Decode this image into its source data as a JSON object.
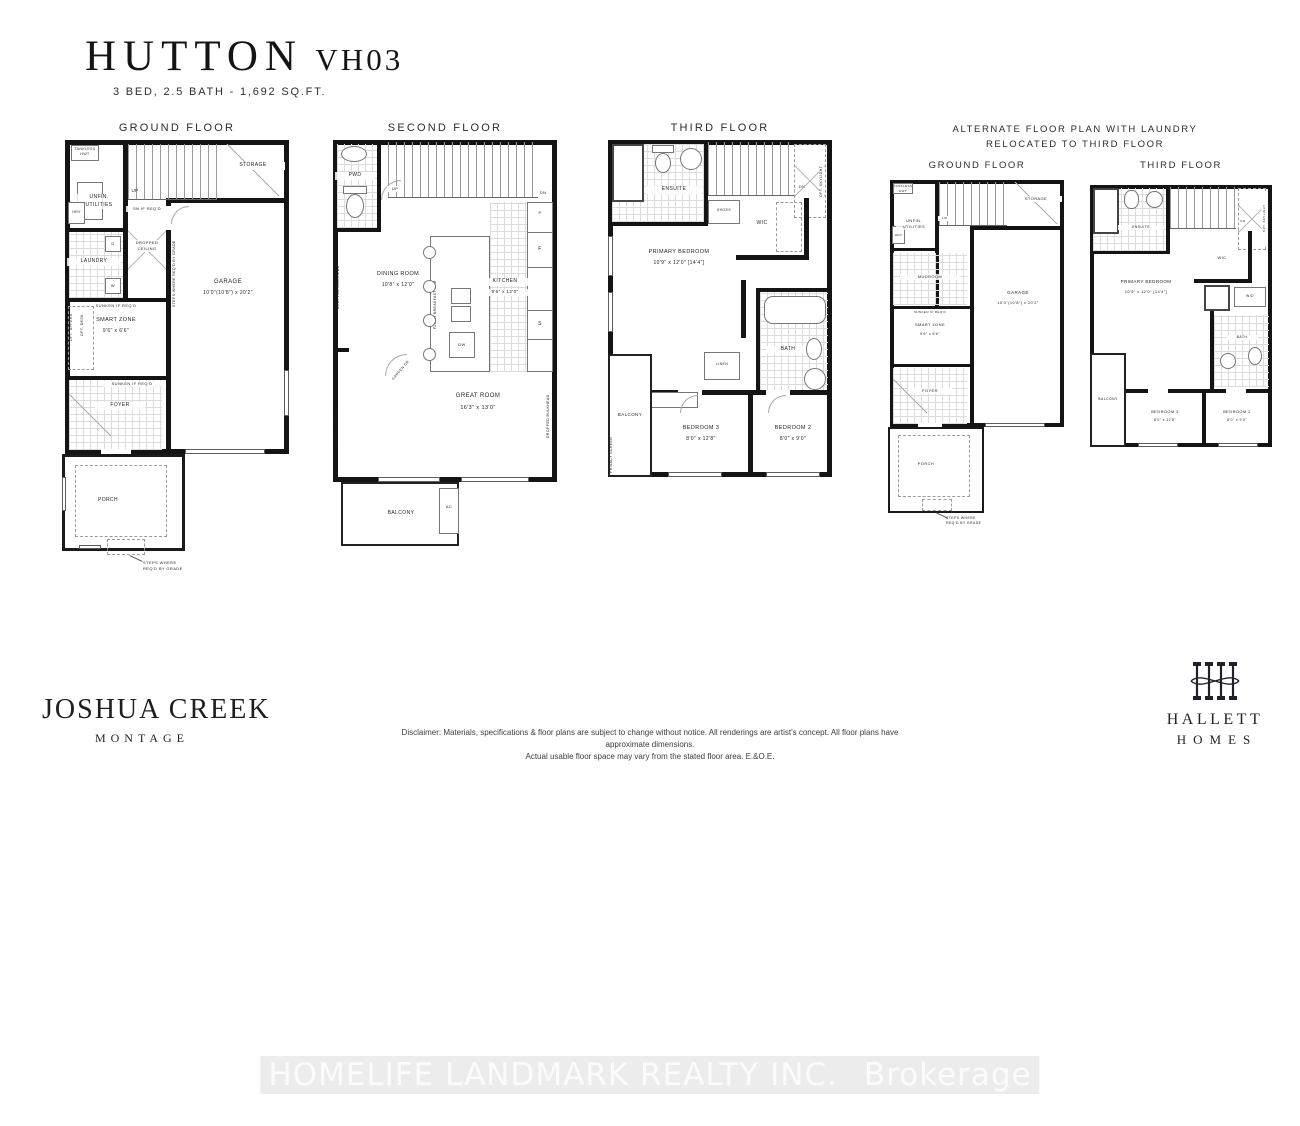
{
  "header": {
    "title": "HUTTON",
    "model": "VH03",
    "subtitle": "3 BED, 2.5 BATH - 1,692 SQ.FT."
  },
  "g": {
    "title": "GROUND FLOOR",
    "storage": "STORAGE",
    "up": "UP",
    "utilities": "UNFIN.\nUTILITIES",
    "tankless": "TANKLESS\nHWT",
    "hrv": "HRV",
    "laundry": "LAUNDRY",
    "d": "D",
    "wl": "W",
    "sn": "SN IF REQ'D",
    "dropped": "DROPPED\nCEILING",
    "garage": "GARAGE",
    "garage_dims": "10'0\"(10'8\") x 20'2\"",
    "steps_vert": "STEPS WHERE REQ'D BY GRADE",
    "sunken": "SUNKEN IF REQ'D",
    "smart": "SMART ZONE",
    "smart_dims": "9'6\" x 6'6\"",
    "opt_uppers": "OPT. UPPERS",
    "opt_desk": "OPT. DESK",
    "foyer": "FOYER",
    "sunken2": "SUNKEN IF REQ'D",
    "porch": "PORCH",
    "steps": "STEPS WHERE\nREQ'D BY GRADE"
  },
  "s": {
    "title": "SECOND FLOOR",
    "pwd": "PWD",
    "up": "UP",
    "dn": "DN",
    "dining": "DINING ROOM",
    "dining_dims": "10'8\" x 12'0\"",
    "bulkhead": "DROPPED BULKHEAD",
    "flush": "FLUSH BREAKFAST BAR",
    "dw": "DW",
    "f": "F",
    "st": "S",
    "p": "P",
    "kitchen": "KITCHEN",
    "kitchen_dims": "9'6\" x 12'0\"",
    "garden": "GARDEN DR",
    "great": "GREAT ROOM",
    "great_dims": "16'3\" x 13'0\"",
    "privacy": "PRIVACY SCREEN",
    "balcony": "BALCONY",
    "ac": "AC"
  },
  "t": {
    "title": "THIRD FLOOR",
    "ensuite": "ENSUITE",
    "dn": "DN",
    "skylight": "OPT. SKYLIGHT",
    "shoes": "SHOES",
    "wic": "WIC",
    "primary": "PRIMARY BEDROOM",
    "primary_dims": "10'9\" x 12'0\" [14'4\"]",
    "bath": "BATH",
    "linen": "LINEN",
    "balcony": "BALCONY",
    "privacy": "PRIVACY SCREEN",
    "bed3": "BEDROOM 3",
    "bed3_dims": "8'0\" x 12'8\"",
    "bed2": "BEDROOM 2",
    "bed2_dims": "8'0\" x 9'0\""
  },
  "alt": {
    "header": "ALTERNATE FLOOR PLAN WITH LAUNDRY\nRELOCATED TO THIRD FLOOR",
    "ground_title": "GROUND FLOOR",
    "third_title": "THIRD FLOOR",
    "g": {
      "storage": "STORAGE",
      "up": "UP",
      "utilities": "UNFIN.\nUTILITIES",
      "tankless": "TANKLESS\nHWT",
      "hrv": "HRV",
      "mudroom": "MUDROOM",
      "garage": "GARAGE",
      "garage_dims": "10'0\"(10'8\") x 20'2\"",
      "smart": "SMART ZONE",
      "smart_dims": "9'6\" x 6'6\"",
      "sunken": "SUNKEN IF REQ'D",
      "foyer": "FOYER",
      "porch": "PORCH",
      "steps": "STEPS WHERE\nREQ'D BY GRADE"
    },
    "t": {
      "ensuite": "ENSUITE",
      "dn": "DN",
      "wic": "WIC",
      "skylight": "OPT. SKYLIGHT",
      "primary": "PRIMARY BEDROOM",
      "primary_dims": "10'9\" x 12'0\" [14'4\"]",
      "wd": "W/D",
      "bath": "BATH",
      "balcony": "BALCONY",
      "bed3": "BEDROOM 3",
      "bed3_dims": "8'0\" x 12'8\"",
      "bed2": "BEDROOM 2",
      "bed2_dims": "8'0\" x 9'0\""
    }
  },
  "footer": {
    "community": "JOSHUA CREEK",
    "community_sub": "MONTAGE",
    "disclaimer": "Disclaimer: Materials, specifications & floor plans are subject to change without notice. All renderings are artist's concept. All floor plans have approximate dimensions.\nActual usable floor space may vary from the stated floor area. E.&O.E.",
    "builder_name": "HALLETT",
    "builder_type": "HOMES"
  },
  "wm": {
    "line": "HOMELIFE LANDMARK REALTY INC.",
    "suffix": "Brokerage"
  }
}
